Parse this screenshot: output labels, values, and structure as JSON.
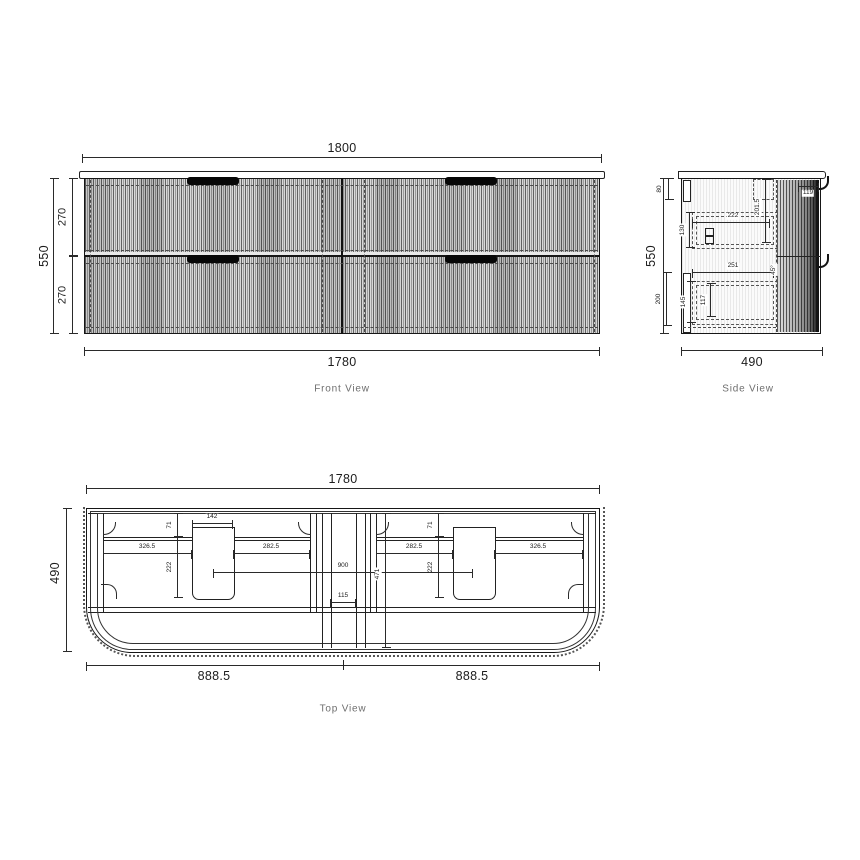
{
  "front": {
    "label": "Front View",
    "top_width": "1800",
    "bottom_width": "1780",
    "height": "550",
    "upper_drawer_height": "270",
    "lower_drawer_height": "270"
  },
  "side": {
    "label": "Side View",
    "height": "550",
    "depth": "490",
    "top_rail": "80",
    "upper_box_height": "130",
    "upper_box_depth": "222",
    "upper_clearance": "201.5",
    "front_reveal": "119",
    "lower_box_depth": "251",
    "pull_chamfer": "45°",
    "lower_rail": "200",
    "lower_box_height": "145",
    "lower_inner_height": "117"
  },
  "top": {
    "label": "Top View",
    "width": "1780",
    "depth": "490",
    "cutout_width": "142",
    "left_back_gap": "71",
    "left_cutout_depth": "222",
    "left_outer_span": "326.5",
    "left_inner_span": "282.5",
    "right_inner_span": "282.5",
    "right_outer_span": "326.5",
    "right_back_gap": "71",
    "right_cutout_depth": "222",
    "cutout_centres": "900",
    "centre_gap": "115",
    "internal_depth": "471",
    "left_half_width": "888.5",
    "right_half_width": "888.5"
  }
}
